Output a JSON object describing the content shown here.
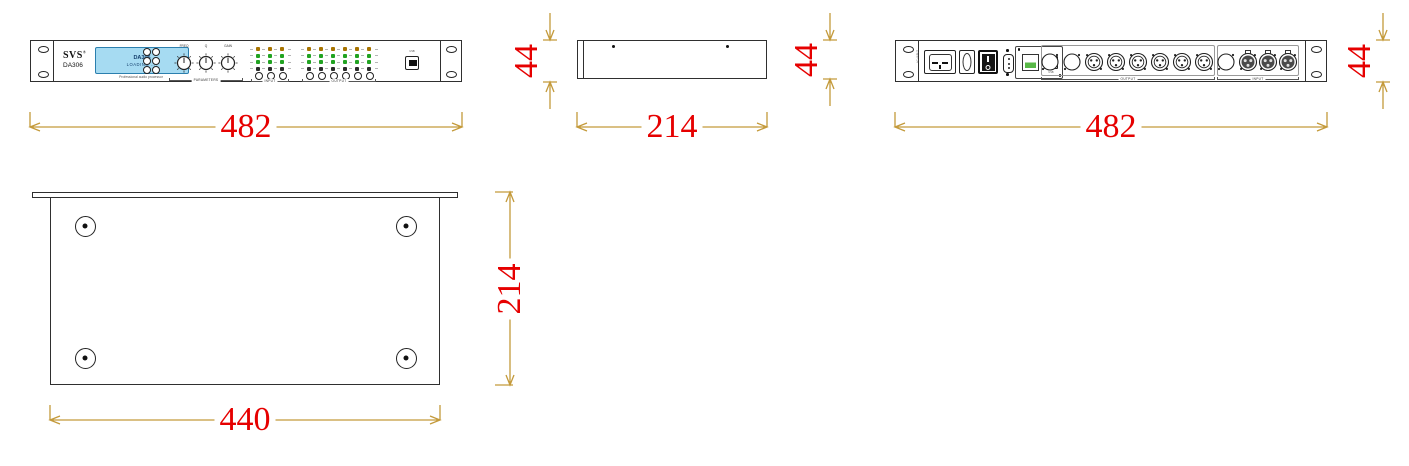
{
  "front": {
    "brand": "SVS",
    "brand_reg": "®",
    "model": "DA306",
    "lcd": {
      "line1": "DA306",
      "line2": "LOADING ....",
      "bg": "#A6DBF2"
    },
    "subtitle": "Professional audio processor",
    "knobs": [
      {
        "label": "FREQ"
      },
      {
        "label": "Q"
      },
      {
        "label": "GAIN"
      }
    ],
    "knob_group_label": "PARAMETERS",
    "meters": {
      "input_label": "INPUT",
      "output_label": "OUTPUT",
      "input_channels": 3,
      "output_channels": 6,
      "led_colors": [
        "#A87400",
        "#21A321",
        "#21A321",
        "#2B2B2B"
      ]
    },
    "usb_label": "USB"
  },
  "rear": {
    "power_label": "AC~INPUT",
    "usb_label": "USB",
    "output_group_label": "OUTPUT",
    "input_group_label": "INPUT",
    "connectors": [
      "blank",
      "blank",
      "xlr-male",
      "xlr-male",
      "xlr-male",
      "xlr-male",
      "xlr-male",
      "xlr-male",
      "blank",
      "xlr-female",
      "xlr-female",
      "xlr-female"
    ]
  },
  "dimensions": [
    {
      "id": "front-width",
      "value": "482"
    },
    {
      "id": "front-height",
      "value": "44"
    },
    {
      "id": "side-depth",
      "value": "214"
    },
    {
      "id": "side-height",
      "value": "44"
    },
    {
      "id": "rear-width",
      "value": "482"
    },
    {
      "id": "rear-height",
      "value": "44"
    },
    {
      "id": "bottom-width",
      "value": "440"
    },
    {
      "id": "bottom-depth",
      "value": "214"
    }
  ],
  "colors": {
    "dimension_line": "#C49A3B",
    "dimension_text": "#E60000",
    "panel_outline": "#2F2F2F",
    "lcd_bg": "#A6DBF2",
    "rj45_green": "#58B847"
  }
}
